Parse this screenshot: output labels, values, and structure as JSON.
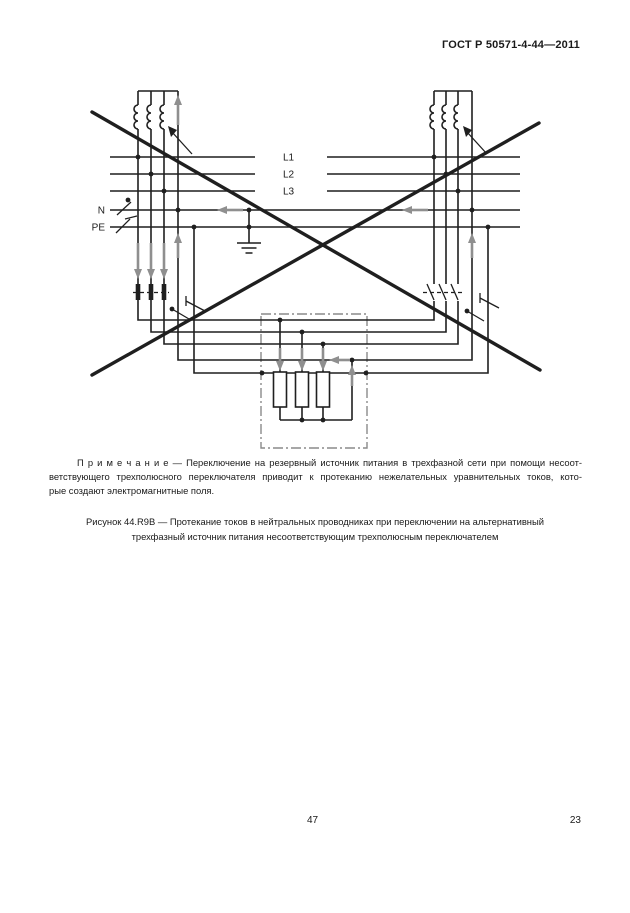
{
  "header": {
    "title": "ГОСТ Р 50571-4-44—2011"
  },
  "diagram": {
    "labels": {
      "l1": "L1",
      "l2": "L2",
      "l3": "L3",
      "n": "N",
      "pe": "PE"
    },
    "colors": {
      "line": "#1f1f1f",
      "arrow": "#8f8f8f",
      "enclosure": "#8a8a8a"
    }
  },
  "note": {
    "lines": [
      "П р и м е ч а н и е — Переключение на резервный источник питания в трехфазной сети при помощи несоот-",
      "ветствующего трехполюсного переключателя приводит к протеканию нежелательных уравнительных токов, кото-",
      "рые создают электромагнитные поля."
    ]
  },
  "caption": {
    "lines": [
      "Рисунок 44.R9B — Протекание токов в нейтральных проводниках при переключении на альтернативный",
      "трехфазный источник питания несоответствующим трехполюсным переключателем"
    ]
  },
  "footer": {
    "page_number": "47",
    "sheet_number": "23"
  }
}
